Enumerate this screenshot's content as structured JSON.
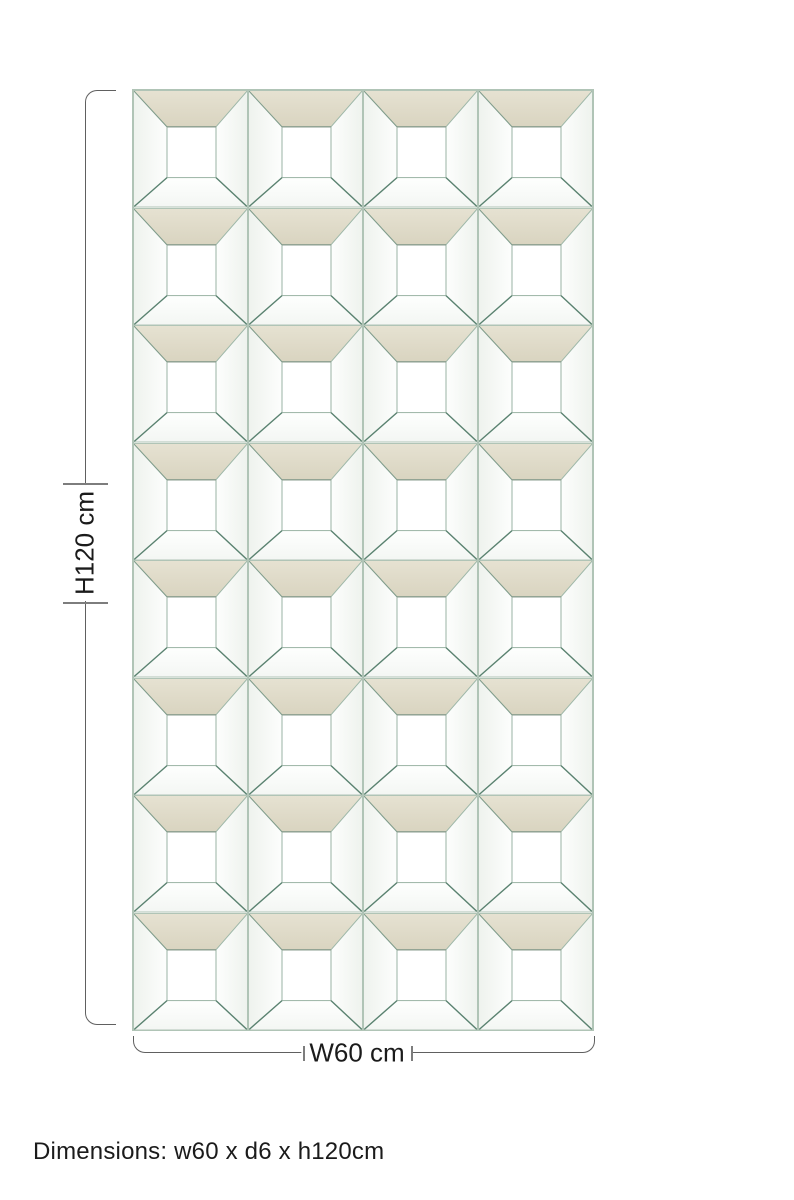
{
  "panel": {
    "description": "mirrored-wall-panel-front-view",
    "grid": {
      "rows": 8,
      "cols": 4
    }
  },
  "annotations": {
    "height_label": "H120 cm",
    "width_label": "W60 cm"
  },
  "caption": {
    "text": "Dimensions: w60 x d6 x h120cm"
  },
  "colors": {
    "bevel-beige": "#d9d4c0",
    "bevel-beige-light": "#e6e2d2",
    "mirror-line": "#7f9c8b",
    "mirror-line-dark": "#5a8270",
    "mirror-line-light": "#9db7a8",
    "tile-border": "#b0c4b6",
    "dim-line": "#606060",
    "dim-tick": "#7d7d7d",
    "text": "#1b1b1b",
    "background": "#ffffff"
  }
}
